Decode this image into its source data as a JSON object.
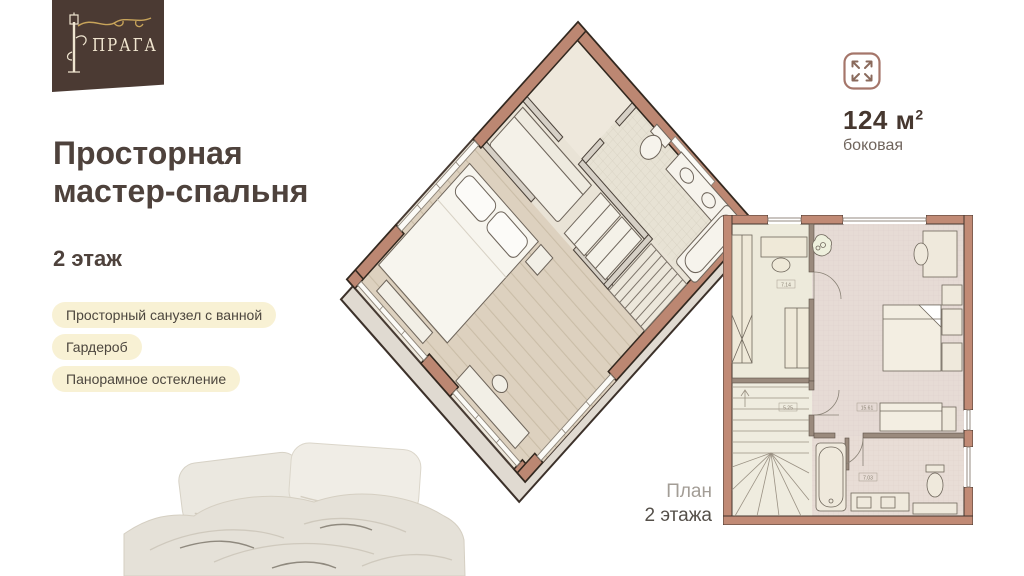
{
  "brand": {
    "name": "ПРАГА"
  },
  "header": {
    "title_line1": "Просторная",
    "title_line2": "мастер-спальня",
    "floor": "2 этаж"
  },
  "features": {
    "items": [
      "Просторный санузел с ванной",
      "Гардероб",
      "Панорамное остекление"
    ]
  },
  "area": {
    "value": "124 м",
    "superscript": "2",
    "subtitle": "боковая"
  },
  "plan": {
    "caption_line1": "План",
    "caption_line2": "2 этажа",
    "room_labels": {
      "closet": "7.14",
      "stairs": "5.25",
      "bedroom": "15.61",
      "bathroom": "7.03"
    }
  },
  "colors": {
    "logo_brown": "#4b3a33",
    "gold": "#c8a45a",
    "heading": "#4e423c",
    "badge_cream": "#f8f1d4",
    "terracotta": "#bc8772"
  }
}
